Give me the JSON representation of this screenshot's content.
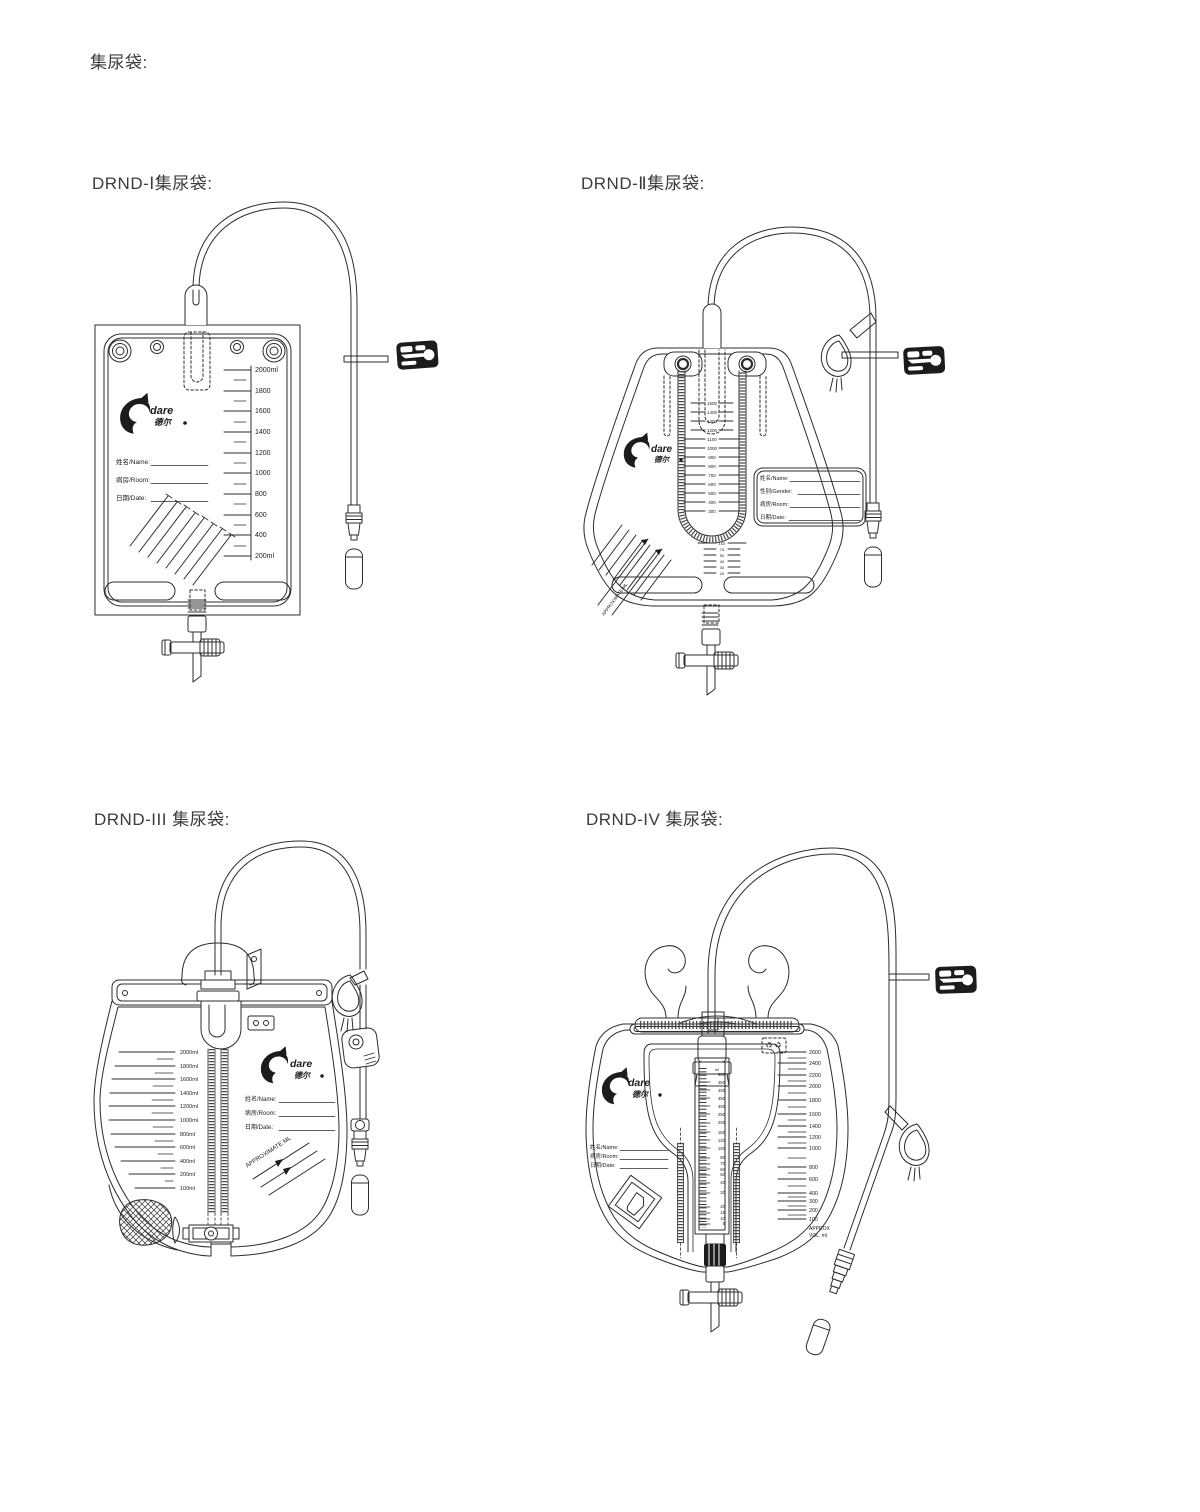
{
  "page": {
    "title": "集尿袋:",
    "background": "#ffffff",
    "line_color": "#2c2c2c"
  },
  "sections": {
    "drnd1": {
      "label": "DRND-Ⅰ集尿袋:",
      "logo": {
        "brand": "dare",
        "brand_cn": "德尔"
      },
      "fields": {
        "name": "姓名/Name:",
        "room": "病房/Room:",
        "date": "日期/Date:"
      },
      "scale_labels": [
        "2000ml",
        "1800",
        "1600",
        "1400",
        "1200",
        "1000",
        "800",
        "600",
        "400",
        "200ml"
      ]
    },
    "drnd2": {
      "label": "DRND-Ⅱ集尿袋:",
      "logo": {
        "brand": "dare",
        "brand_cn": "德尔"
      },
      "fields": {
        "name": "姓名/Name:",
        "gender": "性别/Gender:",
        "room": "病房/Room:",
        "date": "日期/Date:"
      },
      "scale_labels": [
        "1500",
        "1400",
        "1300",
        "1200",
        "1100",
        "1000",
        "900",
        "800",
        "700",
        "600",
        "500",
        "400",
        "300"
      ],
      "small_scale_labels": [
        "100",
        "75",
        "50",
        "40",
        "30",
        "20"
      ],
      "approx_text": "APPROXIMATE ML"
    },
    "drnd3": {
      "label": "DRND-III 集尿袋:",
      "logo": {
        "brand": "dare",
        "brand_cn": "德尔"
      },
      "fields": {
        "name": "姓名/Name:",
        "room": "病房/Room:",
        "date": "日期/Date:"
      },
      "scale_labels": [
        "2000ml",
        "1800ml",
        "1600ml",
        "1400ml",
        "1200ml",
        "1000ml",
        "800ml",
        "600ml",
        "400ml",
        "200ml",
        "100ml"
      ],
      "approx_text": "APPROXIMATE ML"
    },
    "drnd4": {
      "label": "DRND-IV 集尿袋:",
      "logo": {
        "brand": "dare",
        "brand_cn": "德尔"
      },
      "fields": {
        "name": "姓名/Name:",
        "room": "病房/Room:",
        "date": "日期/Date:"
      },
      "meter_unit": "ml",
      "meter_labels": [
        "500",
        "450",
        "400",
        "350",
        "300",
        "250",
        "200",
        "150",
        "120",
        "100",
        "80",
        "70",
        "60",
        "50",
        "40",
        "30",
        "20",
        "15",
        "10",
        "5"
      ],
      "scale_labels": [
        "2600",
        "2400",
        "2200",
        "2000",
        "1800",
        "1600",
        "1400",
        "1200",
        "1000",
        "800",
        "600",
        "400",
        "300",
        "200",
        "100"
      ],
      "approx_line1": "APPROX",
      "approx_line2": "VOL. ml"
    }
  }
}
